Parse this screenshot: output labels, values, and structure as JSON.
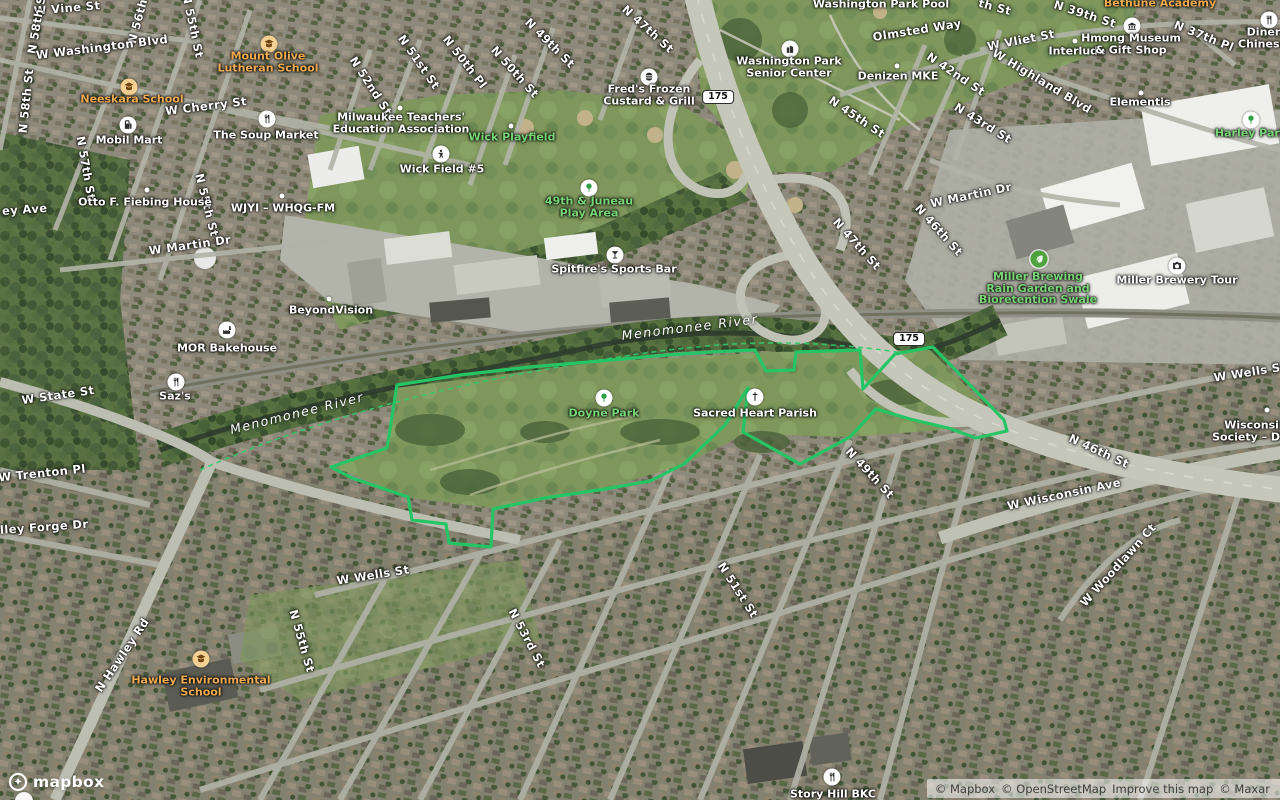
{
  "map": {
    "park_outline": {
      "color": "#25c565",
      "points": "397,385 460,375 530,367 600,361 655,356 710,352 755,350 766,371 794,370 796,352 860,350 863,389 895,354 933,347 1004,420 1007,431 976,438 948,428 910,419 876,409 850,437 800,464 743,432 748,388 725,425 684,464 650,481 605,489 545,498 493,509 491,547 449,543 446,524 412,520 408,497 352,478 331,467 387,448"
    },
    "river_dash_path": "M200,470 C300,425 420,393 520,374 C620,355 700,344 760,343 C820,342 870,348 897,352",
    "shields": [
      {
        "text": "175",
        "x": 718,
        "y": 97
      },
      {
        "text": "175",
        "x": 909,
        "y": 339
      }
    ],
    "street_labels": [
      {
        "text": "W Vine St",
        "x": 67,
        "y": 8,
        "rot": -5
      },
      {
        "text": "N 58th St",
        "x": 37,
        "y": 22,
        "rot": -80
      },
      {
        "text": "N 58th St",
        "x": 26,
        "y": 101,
        "rot": -84
      },
      {
        "text": "N 56th St",
        "x": 140,
        "y": 12,
        "rot": -75
      },
      {
        "text": "N 55th St",
        "x": 193,
        "y": 26,
        "rot": 78
      },
      {
        "text": "W Washington Blvd",
        "x": 102,
        "y": 47,
        "rot": -7
      },
      {
        "text": "W Cherry St",
        "x": 206,
        "y": 106,
        "rot": -7
      },
      {
        "text": "N 57th St",
        "x": 86,
        "y": 168,
        "rot": 80
      },
      {
        "text": "ey Ave",
        "x": 2,
        "y": 211,
        "rot": -4,
        "anchor": "left"
      },
      {
        "text": "N 55th St",
        "x": 207,
        "y": 205,
        "rot": 76
      },
      {
        "text": "W Martin Dr",
        "x": 190,
        "y": 245,
        "rot": -8
      },
      {
        "text": "N 52nd St",
        "x": 371,
        "y": 86,
        "rot": 57
      },
      {
        "text": "N 51st St",
        "x": 419,
        "y": 62,
        "rot": 55
      },
      {
        "text": "N 50th Pl",
        "x": 465,
        "y": 62,
        "rot": 52
      },
      {
        "text": "N 50th St",
        "x": 515,
        "y": 72,
        "rot": 48
      },
      {
        "text": "N 49th St",
        "x": 550,
        "y": 43,
        "rot": 45
      },
      {
        "text": "N 47th St",
        "x": 648,
        "y": 29,
        "rot": 42
      },
      {
        "text": "Olmsted Way",
        "x": 917,
        "y": 30,
        "rot": -9
      },
      {
        "text": "W Vliet St",
        "x": 1021,
        "y": 40,
        "rot": -11
      },
      {
        "text": "N 42nd St",
        "x": 956,
        "y": 74,
        "rot": 34
      },
      {
        "text": "N 45th St",
        "x": 857,
        "y": 117,
        "rot": 34
      },
      {
        "text": "N 43rd St",
        "x": 983,
        "y": 123,
        "rot": 32
      },
      {
        "text": "th St",
        "x": 995,
        "y": 7,
        "rot": 15
      },
      {
        "text": "N 39th St",
        "x": 1085,
        "y": 14,
        "rot": 18
      },
      {
        "text": "N 37th Pl",
        "x": 1204,
        "y": 36,
        "rot": 22
      },
      {
        "text": "W Highland Blvd",
        "x": 1042,
        "y": 81,
        "rot": 31
      },
      {
        "text": "W Martin Dr",
        "x": 971,
        "y": 195,
        "rot": -12
      },
      {
        "text": "N 46th St",
        "x": 939,
        "y": 230,
        "rot": 48
      },
      {
        "text": "N 47th St",
        "x": 857,
        "y": 244,
        "rot": 48
      },
      {
        "text": "W State St",
        "x": 58,
        "y": 395,
        "rot": -8
      },
      {
        "text": "W Trenton Pl",
        "x": 42,
        "y": 473,
        "rot": -6
      },
      {
        "text": "lley Forge Dr",
        "x": 0,
        "y": 530,
        "rot": -4,
        "anchor": "left"
      },
      {
        "text": "N Hawley Rd",
        "x": 122,
        "y": 655,
        "rot": -56
      },
      {
        "text": "N 55th St",
        "x": 302,
        "y": 641,
        "rot": 74
      },
      {
        "text": "W Wells St",
        "x": 373,
        "y": 575,
        "rot": -9
      },
      {
        "text": "N 53rd St",
        "x": 527,
        "y": 638,
        "rot": 62
      },
      {
        "text": "N 51st St",
        "x": 738,
        "y": 590,
        "rot": 57
      },
      {
        "text": "N 49th St",
        "x": 870,
        "y": 473,
        "rot": 47
      },
      {
        "text": "W Wisconsin Ave",
        "x": 1064,
        "y": 494,
        "rot": -12
      },
      {
        "text": "N 46th St",
        "x": 1099,
        "y": 451,
        "rot": 25
      },
      {
        "text": "W Woodlawn Ct",
        "x": 1118,
        "y": 565,
        "rot": -48
      },
      {
        "text": "W Wells St",
        "x": 1250,
        "y": 372,
        "rot": -9
      }
    ],
    "water_labels": [
      {
        "text": "Menomonee River",
        "x": 690,
        "y": 327,
        "rot": -7
      },
      {
        "text": "Menomonee River",
        "x": 297,
        "y": 413,
        "rot": -14
      }
    ],
    "pois": [
      {
        "id": "mount-olive-lutheran-school",
        "icon": "school",
        "ix": 269,
        "iy": 44,
        "tx": 268,
        "ty": 62,
        "color": "orange",
        "lines": [
          "Mount Olive",
          "Lutheran School"
        ]
      },
      {
        "id": "neeskara-school",
        "icon": "school",
        "ix": 129,
        "iy": 87,
        "tx": 132,
        "ty": 99,
        "color": "orange",
        "lines": [
          "Neeskara School"
        ]
      },
      {
        "id": "mobil-mart",
        "icon": "fuel",
        "ix": 128,
        "iy": 125,
        "tx": 129,
        "ty": 140,
        "color": "white",
        "lines": [
          "Mobil Mart"
        ]
      },
      {
        "id": "the-soup-market",
        "icon": "restaurant",
        "ix": 267,
        "iy": 119,
        "tx": 266,
        "ty": 135,
        "color": "white",
        "lines": [
          "The Soup Market"
        ]
      },
      {
        "id": "milwaukee-teachers-education-association",
        "icon": "dot",
        "ix": 400,
        "iy": 108,
        "tx": 401,
        "ty": 123,
        "color": "white",
        "lines": [
          "Milwaukee Teachers'",
          "Education Association"
        ]
      },
      {
        "id": "wick-playfield",
        "icon": "dot",
        "ix": 511,
        "iy": 126,
        "tx": 512,
        "ty": 137,
        "color": "green",
        "lines": [
          "Wick Playfield"
        ]
      },
      {
        "id": "wick-field-5",
        "icon": "pitch",
        "ix": 441,
        "iy": 154,
        "tx": 442,
        "ty": 169,
        "color": "white",
        "lines": [
          "Wick Field #5"
        ]
      },
      {
        "id": "freds-frozen-custard-grill",
        "icon": "fastfood",
        "ix": 649,
        "iy": 77,
        "tx": 649,
        "ty": 95,
        "color": "white",
        "lines": [
          "Fred's Frozen",
          "Custard & Grill"
        ]
      },
      {
        "id": "49th-and-juneau-play-area",
        "icon": "tree",
        "ix": 589,
        "iy": 188,
        "tx": 589,
        "ty": 207,
        "color": "green",
        "lines": [
          "49th & Juneau",
          "Play Area"
        ]
      },
      {
        "id": "spitfires-sports-bar",
        "icon": "bar",
        "ix": 615,
        "iy": 255,
        "tx": 614,
        "ty": 269,
        "color": "white",
        "lines": [
          "Spitfire's Sports Bar"
        ]
      },
      {
        "id": "otto-f-fiebing-house",
        "icon": "dot",
        "ix": 147,
        "iy": 190,
        "tx": 145,
        "ty": 202,
        "color": "white",
        "lines": [
          "Otto F. Fiebing House"
        ]
      },
      {
        "id": "wjyi-whqg-fm",
        "icon": "dot",
        "ix": 282,
        "iy": 196,
        "tx": 283,
        "ty": 208,
        "color": "white",
        "lines": [
          "WJYI – WHQG-FM"
        ]
      },
      {
        "id": "beyondvision",
        "icon": "dot",
        "ix": 329,
        "iy": 299,
        "tx": 331,
        "ty": 310,
        "color": "white",
        "lines": [
          "BeyondVision"
        ]
      },
      {
        "id": "mor-bakehouse",
        "icon": "factory",
        "ix": 227,
        "iy": 330,
        "tx": 227,
        "ty": 348,
        "color": "white",
        "lines": [
          "MOR Bakehouse"
        ]
      },
      {
        "id": "sazs",
        "icon": "restaurant",
        "ix": 176,
        "iy": 382,
        "tx": 175,
        "ty": 396,
        "color": "white",
        "lines": [
          "Saz's"
        ]
      },
      {
        "id": "doyne-park",
        "icon": "tree",
        "ix": 604,
        "iy": 398,
        "tx": 604,
        "ty": 413,
        "color": "green",
        "lines": [
          "Doyne Park"
        ]
      },
      {
        "id": "sacred-heart-parish",
        "icon": "church",
        "ix": 755,
        "iy": 397,
        "tx": 755,
        "ty": 413,
        "color": "white",
        "lines": [
          "Sacred Heart Parish"
        ]
      },
      {
        "id": "washington-park-senior-center",
        "icon": "community",
        "ix": 790,
        "iy": 49,
        "tx": 789,
        "ty": 67,
        "color": "white",
        "lines": [
          "Washington Park",
          "Senior Center"
        ]
      },
      {
        "id": "denizen-mke",
        "icon": "dot",
        "ix": 897,
        "iy": 66,
        "tx": 898,
        "ty": 76,
        "color": "white",
        "lines": [
          "Denizen MKE"
        ]
      },
      {
        "id": "interlude",
        "icon": "dot",
        "ix": 1075,
        "iy": 41,
        "tx": 1077,
        "ty": 51,
        "color": "white",
        "lines": [
          "Interlude"
        ]
      },
      {
        "id": "hmong-museum-gift-shop",
        "icon": "museum",
        "ix": 1132,
        "iy": 26,
        "tx": 1131,
        "ty": 44,
        "color": "white",
        "lines": [
          "Hmong Museum",
          "& Gift Shop"
        ]
      },
      {
        "id": "bethune-academy",
        "icon": null,
        "tx": 1160,
        "ty": 3,
        "color": "orange",
        "lines": [
          "Bethune Academy"
        ]
      },
      {
        "id": "diners-chinese",
        "icon": "restaurant",
        "ix": 1269,
        "iy": 20,
        "tx": 1238,
        "ty": 38,
        "color": "white",
        "anchor": "left",
        "lines": [
          "Dinersla",
          "Chinese Cu"
        ]
      },
      {
        "id": "elementis",
        "icon": "dot",
        "ix": 1141,
        "iy": 93,
        "tx": 1140,
        "ty": 102,
        "color": "white",
        "lines": [
          "Elementis"
        ]
      },
      {
        "id": "harley-park",
        "icon": "tree",
        "ix": 1251,
        "iy": 120,
        "tx": 1251,
        "ty": 133,
        "color": "green",
        "lines": [
          "Harley Park"
        ]
      },
      {
        "id": "miller-brewing-rain-garden",
        "icon": "garden",
        "ix": 1039,
        "iy": 259,
        "tx": 1038,
        "ty": 288,
        "color": "green",
        "lines": [
          "Miller Brewing",
          "Rain Garden and",
          "Bioretention Swale"
        ]
      },
      {
        "id": "miller-brewery-tour",
        "icon": "attraction",
        "ix": 1177,
        "iy": 266,
        "tx": 1177,
        "ty": 280,
        "color": "white",
        "lines": [
          "Miller Brewery Tour"
        ]
      },
      {
        "id": "hawley-environmental-school",
        "icon": "school",
        "ix": 201,
        "iy": 659,
        "tx": 201,
        "ty": 686,
        "color": "orange",
        "lines": [
          "Hawley Environmental",
          "School"
        ]
      },
      {
        "id": "story-hill-bkc",
        "icon": "restaurant",
        "ix": 832,
        "iy": 777,
        "tx": 833,
        "ty": 794,
        "color": "white",
        "lines": [
          "Story Hill BKC"
        ]
      },
      {
        "id": "washington-park-pool",
        "icon": null,
        "tx": 881,
        "ty": 4,
        "color": "white",
        "lines": [
          "Washington Park Pool"
        ]
      },
      {
        "id": "wisconsin-historical-society",
        "icon": "dot",
        "ix": 1267,
        "iy": 410,
        "tx": 1262,
        "ty": 431,
        "color": "white",
        "lines": [
          "Wisconsin H",
          "Society – Dalton"
        ]
      }
    ],
    "attribution": {
      "items": [
        "© Mapbox",
        "© OpenStreetMap",
        "Improve this map",
        "© Maxar"
      ],
      "logo_text": "mapbox"
    }
  }
}
